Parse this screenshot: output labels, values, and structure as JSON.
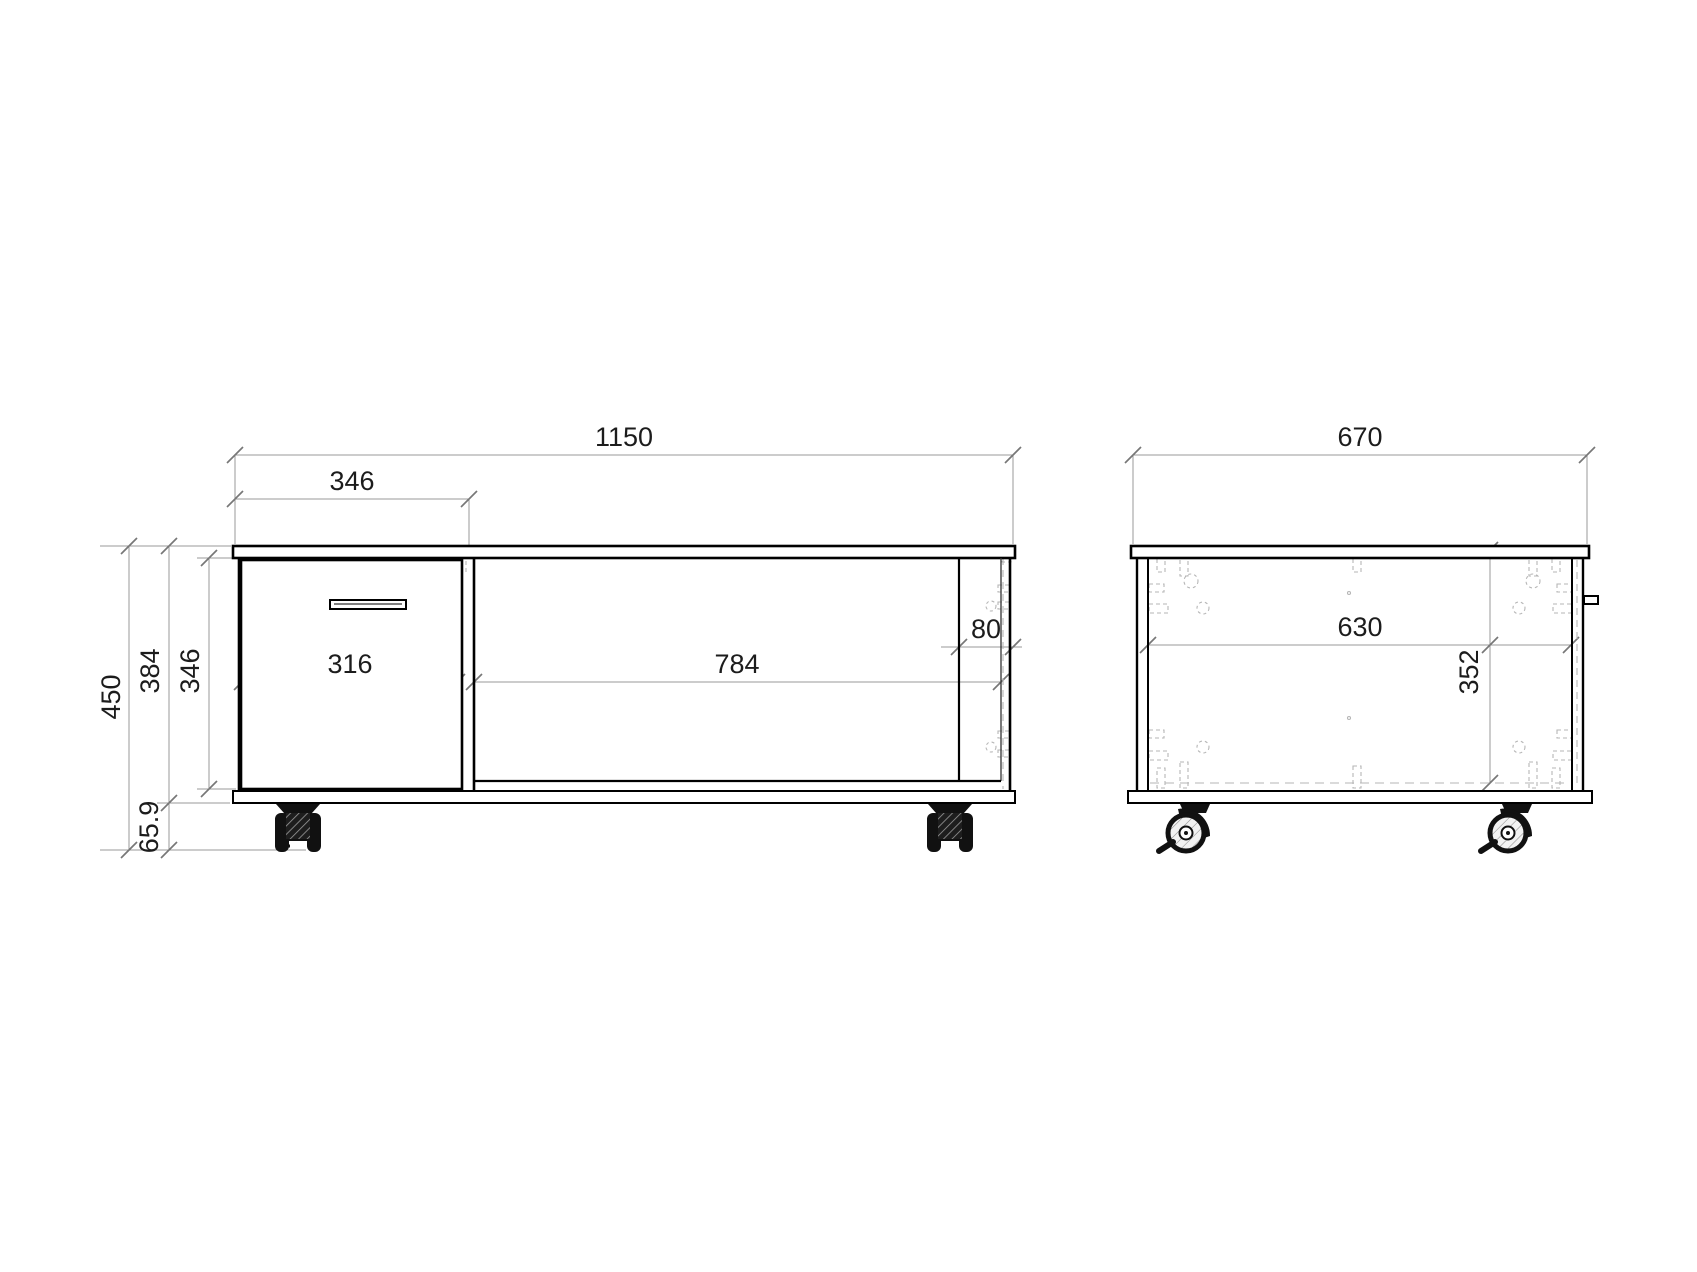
{
  "front_view": {
    "title": "front elevation",
    "dims": {
      "total_width": "1150",
      "drawer_section_width": "346",
      "drawer_front_width": "316",
      "niche_width": "784",
      "side_recess": "80",
      "total_height": "450",
      "body_height": "384",
      "interior_height": "346",
      "caster_height": "65.9"
    }
  },
  "side_view": {
    "title": "side elevation",
    "dims": {
      "total_depth": "670",
      "interior_depth": "630",
      "interior_height": "352"
    }
  },
  "style": {
    "object_line_color": "#000000",
    "dimension_line_color": "#999999",
    "hidden_line_color": "#b6b6b6",
    "text_color": "#1c1c1c",
    "background": "#ffffff"
  }
}
